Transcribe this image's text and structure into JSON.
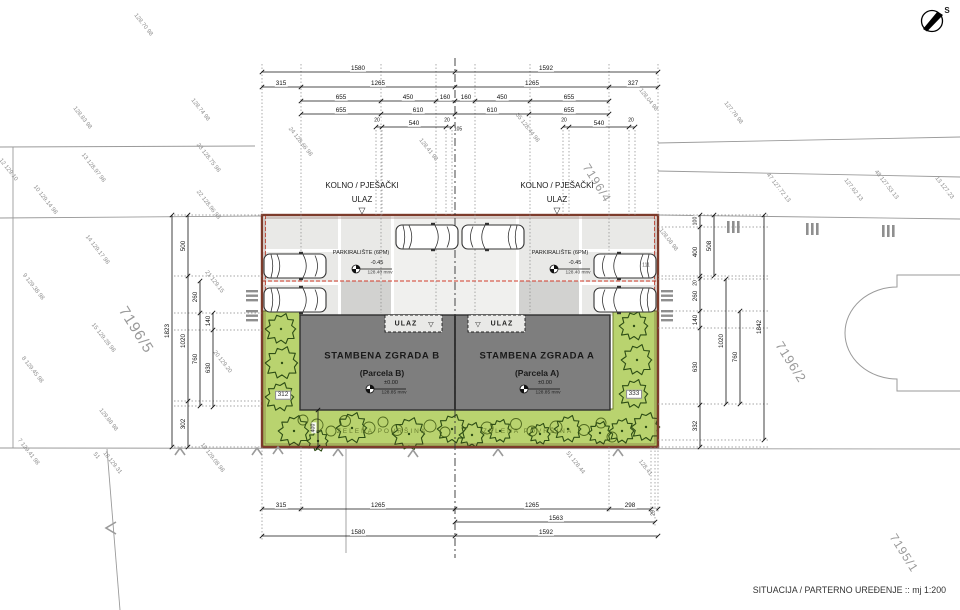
{
  "meta": {
    "title": "SITUACIJA / PARTERNO UREĐENJE :: mj 1:200",
    "north_label": "S"
  },
  "buildings": [
    {
      "name": "STAMBENA ZGRADA B",
      "parcel": "(Parcela B)",
      "elevation": "±0.00",
      "elevation_abs": "128.85 mnv"
    },
    {
      "name": "STAMBENA ZGRADA A",
      "parcel": "(Parcela A)",
      "elevation": "±0.00",
      "elevation_abs": "128.85 mnv"
    }
  ],
  "parking": {
    "label": "PARKIRALIŠTE (6PM)",
    "elevation": "-0.45",
    "elevation_abs": "128.40 mnv"
  },
  "entrance": {
    "line1": "KOLNO / PJEŠAČKI",
    "line2": "ULAZ",
    "building_entrance": "ULAZ"
  },
  "annotations": {
    "dims_top": [
      {
        "t": "1580",
        "x": 358,
        "y": 69
      },
      {
        "t": "1592",
        "x": 546,
        "y": 69
      },
      {
        "t": "315",
        "x": 281,
        "y": 84
      },
      {
        "t": "1265",
        "x": 378,
        "y": 84
      },
      {
        "t": "1265",
        "x": 532,
        "y": 84
      },
      {
        "t": "327",
        "x": 633,
        "y": 84
      },
      {
        "t": "655",
        "x": 341,
        "y": 98
      },
      {
        "t": "450",
        "x": 408,
        "y": 98
      },
      {
        "t": "160",
        "x": 445,
        "y": 98
      },
      {
        "t": "160",
        "x": 466,
        "y": 98
      },
      {
        "t": "450",
        "x": 502,
        "y": 98
      },
      {
        "t": "655",
        "x": 569,
        "y": 98
      },
      {
        "t": "655",
        "x": 341,
        "y": 111
      },
      {
        "t": "610",
        "x": 418,
        "y": 111
      },
      {
        "t": "610",
        "x": 492,
        "y": 111
      },
      {
        "t": "655",
        "x": 569,
        "y": 111
      },
      {
        "t": "20",
        "x": 377,
        "y": 121,
        "s": 5
      },
      {
        "t": "540",
        "x": 414,
        "y": 124
      },
      {
        "t": "20",
        "x": 447,
        "y": 121,
        "s": 5
      },
      {
        "t": "105",
        "x": 458,
        "y": 130,
        "s": 5
      },
      {
        "t": "20",
        "x": 564,
        "y": 121,
        "s": 5
      },
      {
        "t": "540",
        "x": 599,
        "y": 124
      },
      {
        "t": "20",
        "x": 631,
        "y": 121,
        "s": 5
      }
    ],
    "dims_bottom": [
      {
        "t": "315",
        "x": 281,
        "y": 506
      },
      {
        "t": "1265",
        "x": 378,
        "y": 506
      },
      {
        "t": "1265",
        "x": 532,
        "y": 506
      },
      {
        "t": "298",
        "x": 630,
        "y": 506
      },
      {
        "t": "29",
        "x": 654,
        "y": 513,
        "r": -90,
        "s": 5
      },
      {
        "t": "1563",
        "x": 556,
        "y": 519
      },
      {
        "t": "1580",
        "x": 358,
        "y": 533
      },
      {
        "t": "1592",
        "x": 546,
        "y": 533
      }
    ],
    "dims_left": [
      {
        "t": "1823",
        "x": 168,
        "y": 331
      },
      {
        "t": "500",
        "x": 184,
        "y": 246
      },
      {
        "t": "1020",
        "x": 184,
        "y": 341
      },
      {
        "t": "302",
        "x": 184,
        "y": 424
      },
      {
        "t": "260",
        "x": 196,
        "y": 297
      },
      {
        "t": "760",
        "x": 196,
        "y": 359
      },
      {
        "t": "140",
        "x": 209,
        "y": 321
      },
      {
        "t": "630",
        "x": 209,
        "y": 368
      },
      {
        "t": "400",
        "x": 314,
        "y": 428,
        "s": 5.2
      }
    ],
    "dims_right": [
      {
        "t": "100",
        "x": 696,
        "y": 221,
        "s": 5.2
      },
      {
        "t": "400",
        "x": 696,
        "y": 252
      },
      {
        "t": "20",
        "x": 696,
        "y": 283,
        "s": 5
      },
      {
        "t": "260",
        "x": 696,
        "y": 296
      },
      {
        "t": "140",
        "x": 696,
        "y": 320
      },
      {
        "t": "630",
        "x": 696,
        "y": 367
      },
      {
        "t": "332",
        "x": 696,
        "y": 426
      },
      {
        "t": "508",
        "x": 710,
        "y": 246
      },
      {
        "t": "1020",
        "x": 722,
        "y": 341
      },
      {
        "t": "760",
        "x": 736,
        "y": 357
      },
      {
        "t": "1842",
        "x": 760,
        "y": 327
      }
    ],
    "survey": [
      {
        "t": "128.70 98",
        "x": 143,
        "y": 25
      },
      {
        "t": "128.83 98",
        "x": 82,
        "y": 118
      },
      {
        "t": "128.74 98",
        "x": 200,
        "y": 110
      },
      {
        "t": "12 129.10",
        "x": 8,
        "y": 170
      },
      {
        "t": "13 128.97 98",
        "x": 93,
        "y": 168
      },
      {
        "t": "23 128.75 98",
        "x": 208,
        "y": 158
      },
      {
        "t": "10 129.14 98",
        "x": 45,
        "y": 200
      },
      {
        "t": "22 128.96 98",
        "x": 208,
        "y": 205
      },
      {
        "t": "24 128.66 98",
        "x": 300,
        "y": 142
      },
      {
        "t": "128.41 98",
        "x": 428,
        "y": 150
      },
      {
        "t": "85 128.44 98",
        "x": 527,
        "y": 128
      },
      {
        "t": "128.04 98",
        "x": 648,
        "y": 100
      },
      {
        "t": "127.78 98",
        "x": 733,
        "y": 113
      },
      {
        "t": "47 127.72 13",
        "x": 778,
        "y": 188
      },
      {
        "t": "127.62 13",
        "x": 853,
        "y": 190
      },
      {
        "t": "48 127.53 13",
        "x": 886,
        "y": 185
      },
      {
        "t": "13 127.23",
        "x": 944,
        "y": 188
      },
      {
        "t": "14 129.17 98",
        "x": 97,
        "y": 250
      },
      {
        "t": "9 129.38 98",
        "x": 33,
        "y": 287
      },
      {
        "t": "15 129.28 98",
        "x": 103,
        "y": 338
      },
      {
        "t": "8 129.45 98",
        "x": 32,
        "y": 370
      },
      {
        "t": "129.88 98",
        "x": 108,
        "y": 420
      },
      {
        "t": "7 129.41 98",
        "x": 28,
        "y": 452
      },
      {
        "t": "51",
        "x": 96,
        "y": 456
      },
      {
        "t": "18 129.31",
        "x": 112,
        "y": 463
      },
      {
        "t": "19 129.08 98",
        "x": 212,
        "y": 458
      },
      {
        "t": "21 129.15",
        "x": 214,
        "y": 282
      },
      {
        "t": "20 129.20",
        "x": 222,
        "y": 362
      },
      {
        "t": "51 128.44",
        "x": 575,
        "y": 463
      },
      {
        "t": "128.41",
        "x": 645,
        "y": 468
      },
      {
        "t": "128.08 98",
        "x": 668,
        "y": 240
      }
    ],
    "parcels": [
      {
        "t": "7196/5",
        "x": 136,
        "y": 330,
        "s": 15
      },
      {
        "t": "7196/4",
        "x": 597,
        "y": 183,
        "s": 12
      },
      {
        "t": "7196/2",
        "x": 791,
        "y": 362,
        "s": 13
      },
      {
        "t": "7195/1",
        "x": 904,
        "y": 553,
        "s": 12
      }
    ],
    "labels": [
      {
        "t": "ZELENA POVRŠINA",
        "x": 382,
        "y": 432,
        "c": "greenlbl"
      },
      {
        "t": "ZELENA POVRŠINA",
        "x": 528,
        "y": 432,
        "c": "greenlbl"
      },
      {
        "t": "312",
        "x": 283,
        "y": 395,
        "c": "boxed"
      },
      {
        "t": "333",
        "x": 634,
        "y": 394,
        "c": "boxed"
      },
      {
        "t": "111",
        "x": 646,
        "y": 266,
        "c": "tag",
        "s": 5
      },
      {
        "t": "▽",
        "x": 362,
        "y": 211,
        "s": 9,
        "c": "tri"
      },
      {
        "t": "▽",
        "x": 557,
        "y": 211,
        "s": 9,
        "c": "tri"
      },
      {
        "t": "▽",
        "x": 431,
        "y": 325,
        "s": 7,
        "c": "tri"
      },
      {
        "t": "▽",
        "x": 478,
        "y": 325,
        "s": 7,
        "c": "tri"
      }
    ]
  },
  "cars": [
    {
      "x": 295,
      "y": 266,
      "f": 1
    },
    {
      "x": 295,
      "y": 300,
      "f": 1
    },
    {
      "x": 427,
      "y": 237,
      "f": 1
    },
    {
      "x": 493,
      "y": 237,
      "f": -1
    },
    {
      "x": 625,
      "y": 266,
      "f": -1
    },
    {
      "x": 625,
      "y": 300,
      "f": -1
    }
  ],
  "trees": [
    {
      "x": 281,
      "y": 329,
      "r": 16
    },
    {
      "x": 282,
      "y": 363,
      "r": 17
    },
    {
      "x": 280,
      "y": 397,
      "r": 15
    },
    {
      "x": 294,
      "y": 431,
      "r": 16
    },
    {
      "x": 318,
      "y": 441,
      "r": 11
    },
    {
      "x": 352,
      "y": 428,
      "r": 16
    },
    {
      "x": 409,
      "y": 434,
      "r": 17
    },
    {
      "x": 452,
      "y": 429,
      "r": 15
    },
    {
      "x": 472,
      "y": 435,
      "r": 13
    },
    {
      "x": 500,
      "y": 431,
      "r": 12
    },
    {
      "x": 540,
      "y": 434,
      "r": 11
    },
    {
      "x": 568,
      "y": 429,
      "r": 14
    },
    {
      "x": 600,
      "y": 433,
      "r": 12
    },
    {
      "x": 622,
      "y": 431,
      "r": 13
    },
    {
      "x": 646,
      "y": 427,
      "r": 15
    },
    {
      "x": 634,
      "y": 394,
      "r": 15
    },
    {
      "x": 637,
      "y": 360,
      "r": 16
    },
    {
      "x": 634,
      "y": 326,
      "r": 15
    }
  ],
  "bushes": [
    {
      "x": 303,
      "y": 420,
      "r": 5
    },
    {
      "x": 317,
      "y": 425,
      "r": 6
    },
    {
      "x": 331,
      "y": 431,
      "r": 5
    },
    {
      "x": 345,
      "y": 421,
      "r": 5.5
    },
    {
      "x": 369,
      "y": 428,
      "r": 6
    },
    {
      "x": 383,
      "y": 422,
      "r": 5
    },
    {
      "x": 397,
      "y": 430,
      "r": 5.5
    },
    {
      "x": 430,
      "y": 426,
      "r": 6
    },
    {
      "x": 445,
      "y": 432,
      "r": 5
    },
    {
      "x": 487,
      "y": 428,
      "r": 6
    },
    {
      "x": 516,
      "y": 424,
      "r": 5.5
    },
    {
      "x": 532,
      "y": 431,
      "r": 5
    },
    {
      "x": 556,
      "y": 427,
      "r": 6
    },
    {
      "x": 584,
      "y": 430,
      "r": 5.5
    },
    {
      "x": 601,
      "y": 423,
      "r": 5
    },
    {
      "x": 612,
      "y": 437,
      "r": 5
    }
  ]
}
